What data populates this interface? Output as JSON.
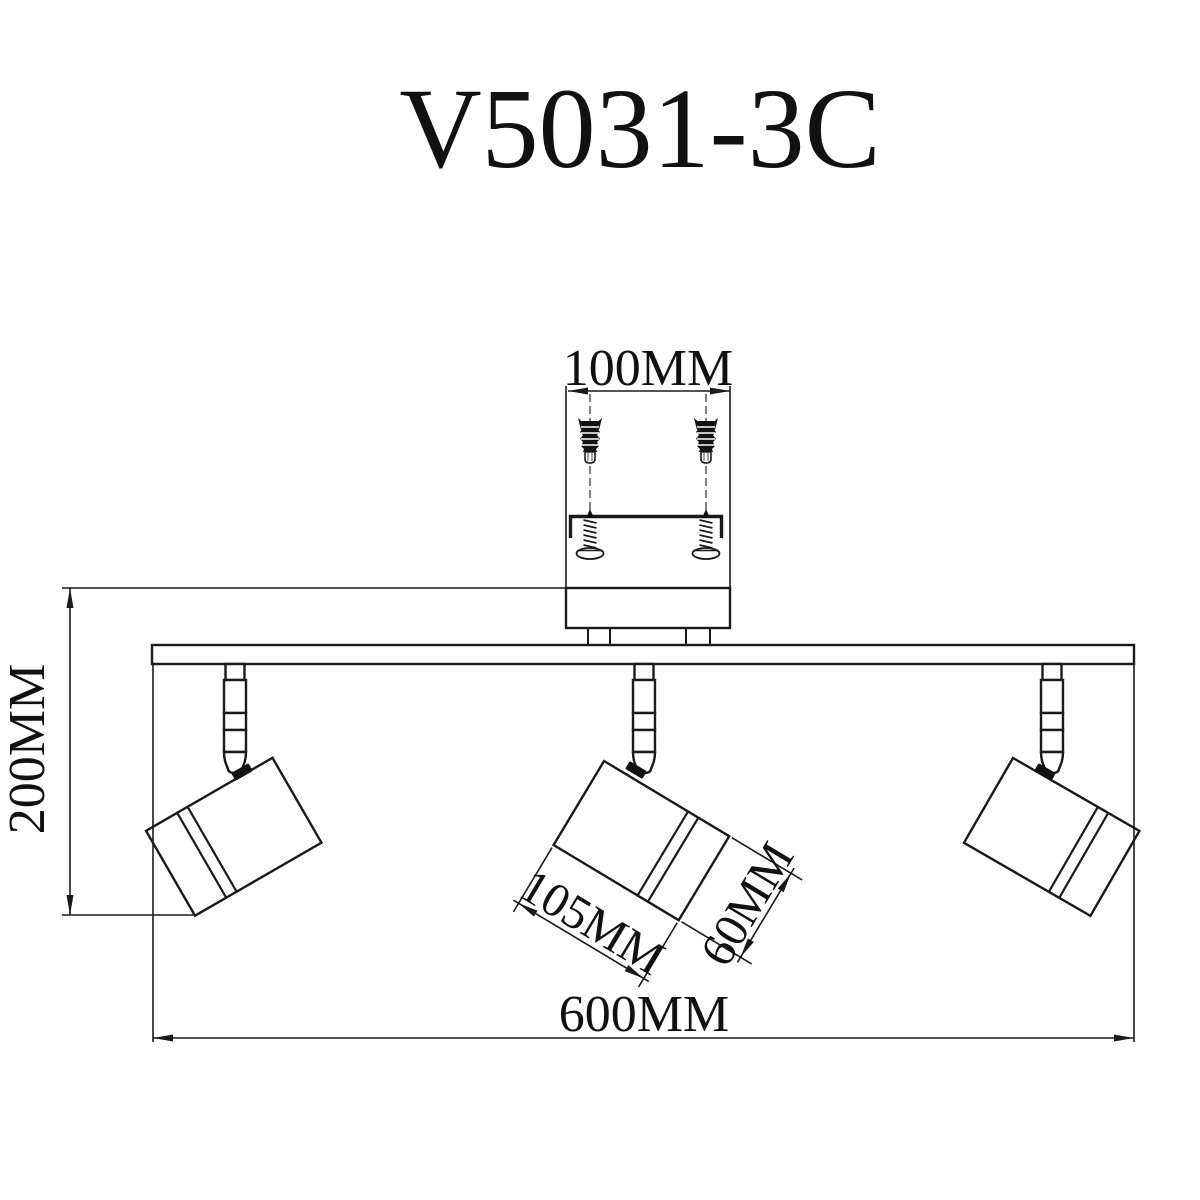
{
  "title": "V5031-3C",
  "colors": {
    "line": "#1a1a1a",
    "background": "#ffffff"
  },
  "dimensions": {
    "hole_spacing": {
      "label": "100MM"
    },
    "fixture_height": {
      "label": "200MM"
    },
    "head_length": {
      "label": "105MM"
    },
    "head_diameter": {
      "label": "60MM"
    },
    "bar_width": {
      "label": "600MM"
    }
  }
}
